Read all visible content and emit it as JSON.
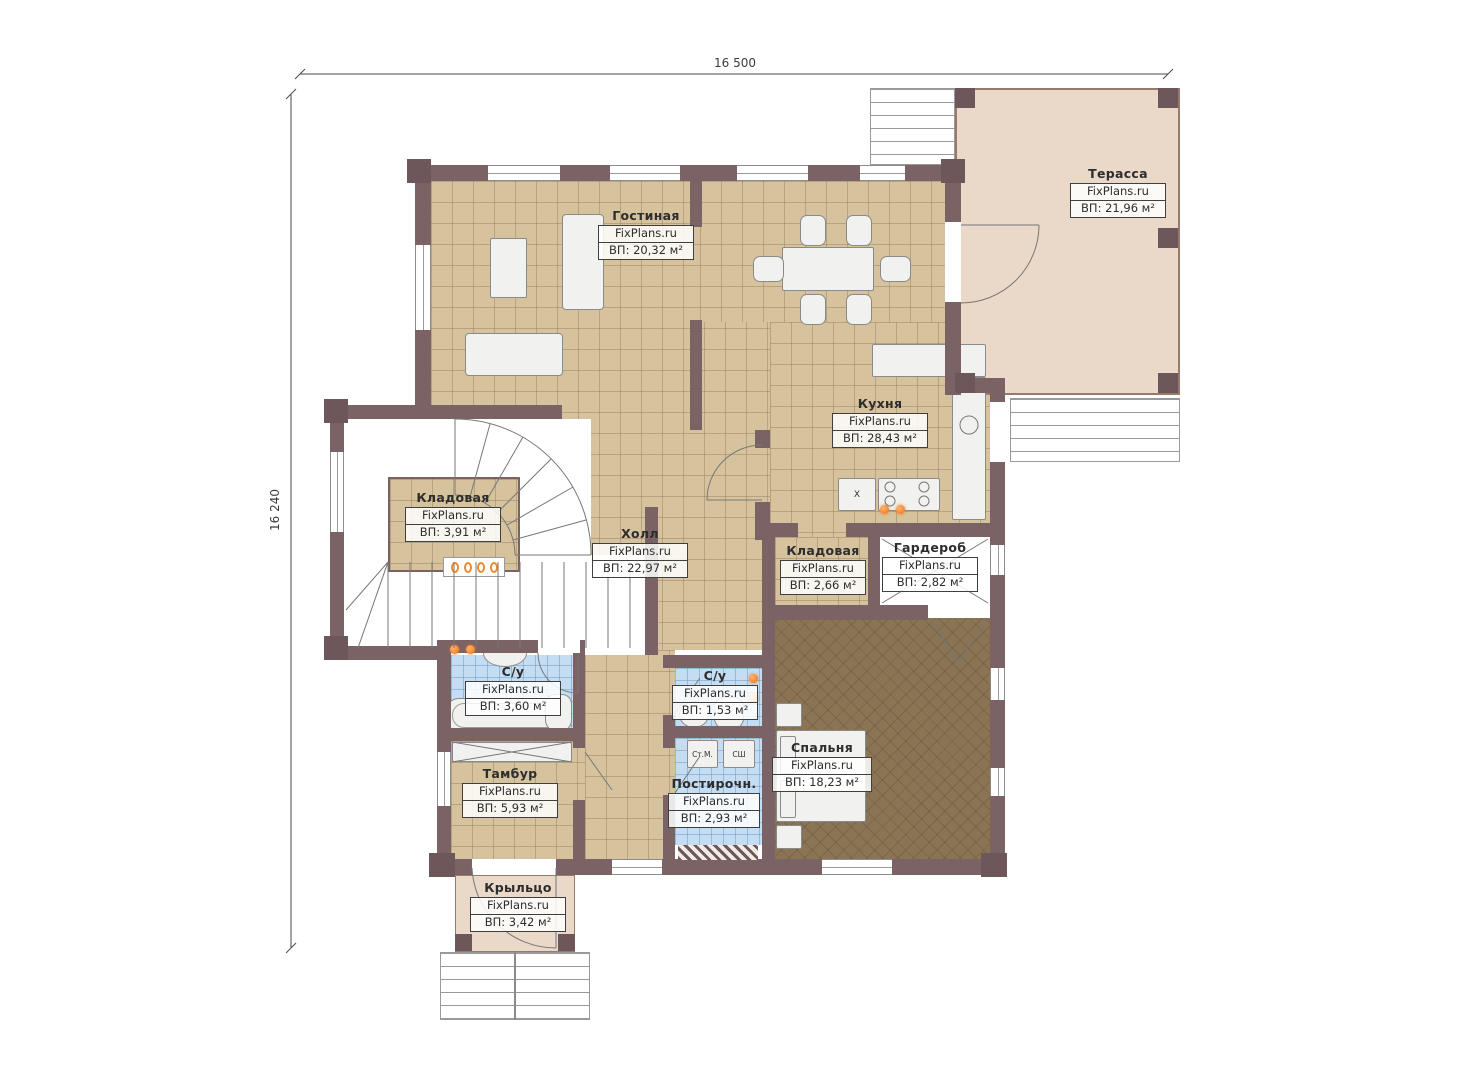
{
  "watermark": "FixPlans.ru",
  "dimensions": {
    "top": "16 500",
    "left": "16 240"
  },
  "rooms": [
    {
      "name": "Терасса",
      "site": "FixPlans.ru",
      "area": "ВП: 21,96 м²"
    },
    {
      "name": "Гостиная",
      "site": "FixPlans.ru",
      "area": "ВП: 20,32 м²"
    },
    {
      "name": "Кухня",
      "site": "FixPlans.ru",
      "area": "ВП: 28,43 м²"
    },
    {
      "name": "Холл",
      "site": "FixPlans.ru",
      "area": "ВП: 22,97 м²"
    },
    {
      "name": "Кладовая",
      "site": "FixPlans.ru",
      "area": "ВП: 3,91 м²"
    },
    {
      "name": "Кладовая",
      "site": "FixPlans.ru",
      "area": "ВП: 2,66 м²"
    },
    {
      "name": "Гардероб",
      "site": "FixPlans.ru",
      "area": "ВП: 2,82 м²"
    },
    {
      "name": "С/у",
      "site": "FixPlans.ru",
      "area": "ВП: 3,60 м²"
    },
    {
      "name": "С/у",
      "site": "FixPlans.ru",
      "area": "ВП: 1,53 м²"
    },
    {
      "name": "Спальня",
      "site": "FixPlans.ru",
      "area": "ВП: 18,23 м²"
    },
    {
      "name": "Тамбур",
      "site": "FixPlans.ru",
      "area": "ВП: 5,93 м²"
    },
    {
      "name": "Постирочн.",
      "site": "FixPlans.ru",
      "area": "ВП: 2,93 м²"
    },
    {
      "name": "Крыльцо",
      "site": "FixPlans.ru",
      "area": "ВП: 3,42 м²"
    }
  ],
  "appliances": {
    "washer_label": "Ст.М.",
    "dryer_label": "СШ",
    "fridge_label": "Х"
  },
  "colors": {
    "wall": "#7b6365",
    "tile": "#d6c39d",
    "wet_tile": "#c5ddf2",
    "carpet": "#8b7454",
    "terrace": "#ead9c9",
    "radiator": "#ee7116"
  }
}
